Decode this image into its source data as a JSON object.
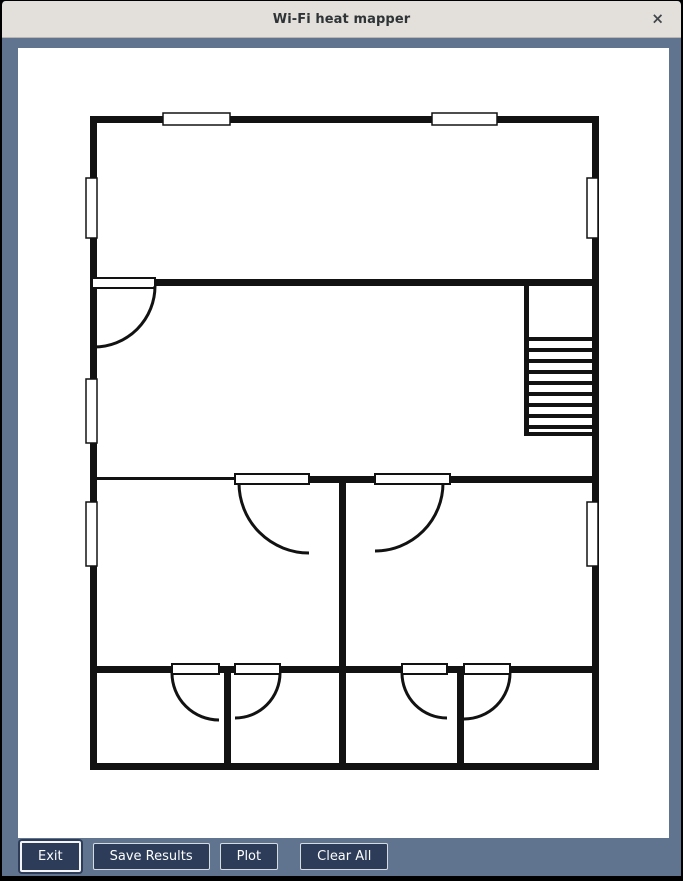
{
  "window": {
    "title": "Wi-Fi heat mapper",
    "close_icon": "×"
  },
  "colors": {
    "frame_bg": "#60748f",
    "titlebar_bg": "#e3e0db",
    "button_bg": "#2c3c59",
    "button_text": "#fdfdfd",
    "canvas_bg": "#ffffff",
    "plan_stroke": "#121212"
  },
  "footer": {
    "buttons": [
      {
        "label": "Exit"
      },
      {
        "label": "Save Results"
      },
      {
        "label": "Plot"
      },
      {
        "label": "Clear All"
      }
    ]
  },
  "floorplan": {
    "stroke": "#121212",
    "walls": [
      [
        88,
        115,
        509,
        7
      ],
      [
        88,
        762,
        509,
        7
      ],
      [
        88,
        115,
        7,
        654
      ],
      [
        590,
        115,
        7,
        654
      ],
      [
        153,
        278,
        444,
        7
      ],
      [
        95,
        476,
        138,
        3
      ],
      [
        307,
        475,
        290,
        7
      ],
      [
        88,
        665,
        509,
        7
      ],
      [
        337,
        475,
        7,
        294
      ],
      [
        222,
        672,
        7,
        97
      ],
      [
        455,
        672,
        7,
        97
      ],
      [
        522,
        285,
        5,
        150
      ]
    ],
    "stair": {
      "x": 527,
      "w": 63,
      "h": 4,
      "steps": [
        336,
        347,
        358,
        369,
        380,
        391,
        402,
        413,
        424,
        431
      ]
    },
    "windows": [
      [
        161,
        112,
        67,
        12
      ],
      [
        430,
        112,
        65,
        12
      ],
      [
        84,
        177,
        11,
        60
      ],
      [
        84,
        378,
        11,
        64
      ],
      [
        84,
        501,
        11,
        64
      ],
      [
        585,
        177,
        11,
        60
      ],
      [
        585,
        501,
        11,
        64
      ]
    ],
    "door_leaves": [
      [
        90,
        277,
        63,
        10
      ],
      [
        233,
        473,
        74,
        10
      ],
      [
        373,
        473,
        75,
        10
      ],
      [
        170,
        663,
        47,
        10
      ],
      [
        233,
        663,
        45,
        10
      ],
      [
        400,
        663,
        45,
        10
      ],
      [
        462,
        663,
        46,
        10
      ]
    ],
    "door_arcs": [
      "M153 285 A61 61 0 0 1 92 346",
      "M237 482 A70 70 0 0 0 307 552",
      "M441 482 A68 68 0 0 1 373 550",
      "M170 672 A47 47 0 0 0 217 719",
      "M278 672 A45 45 0 0 1 233 717",
      "M400 672 A45 45 0 0 0 445 717",
      "M508 672 A46 46 0 0 1 462 718"
    ]
  }
}
